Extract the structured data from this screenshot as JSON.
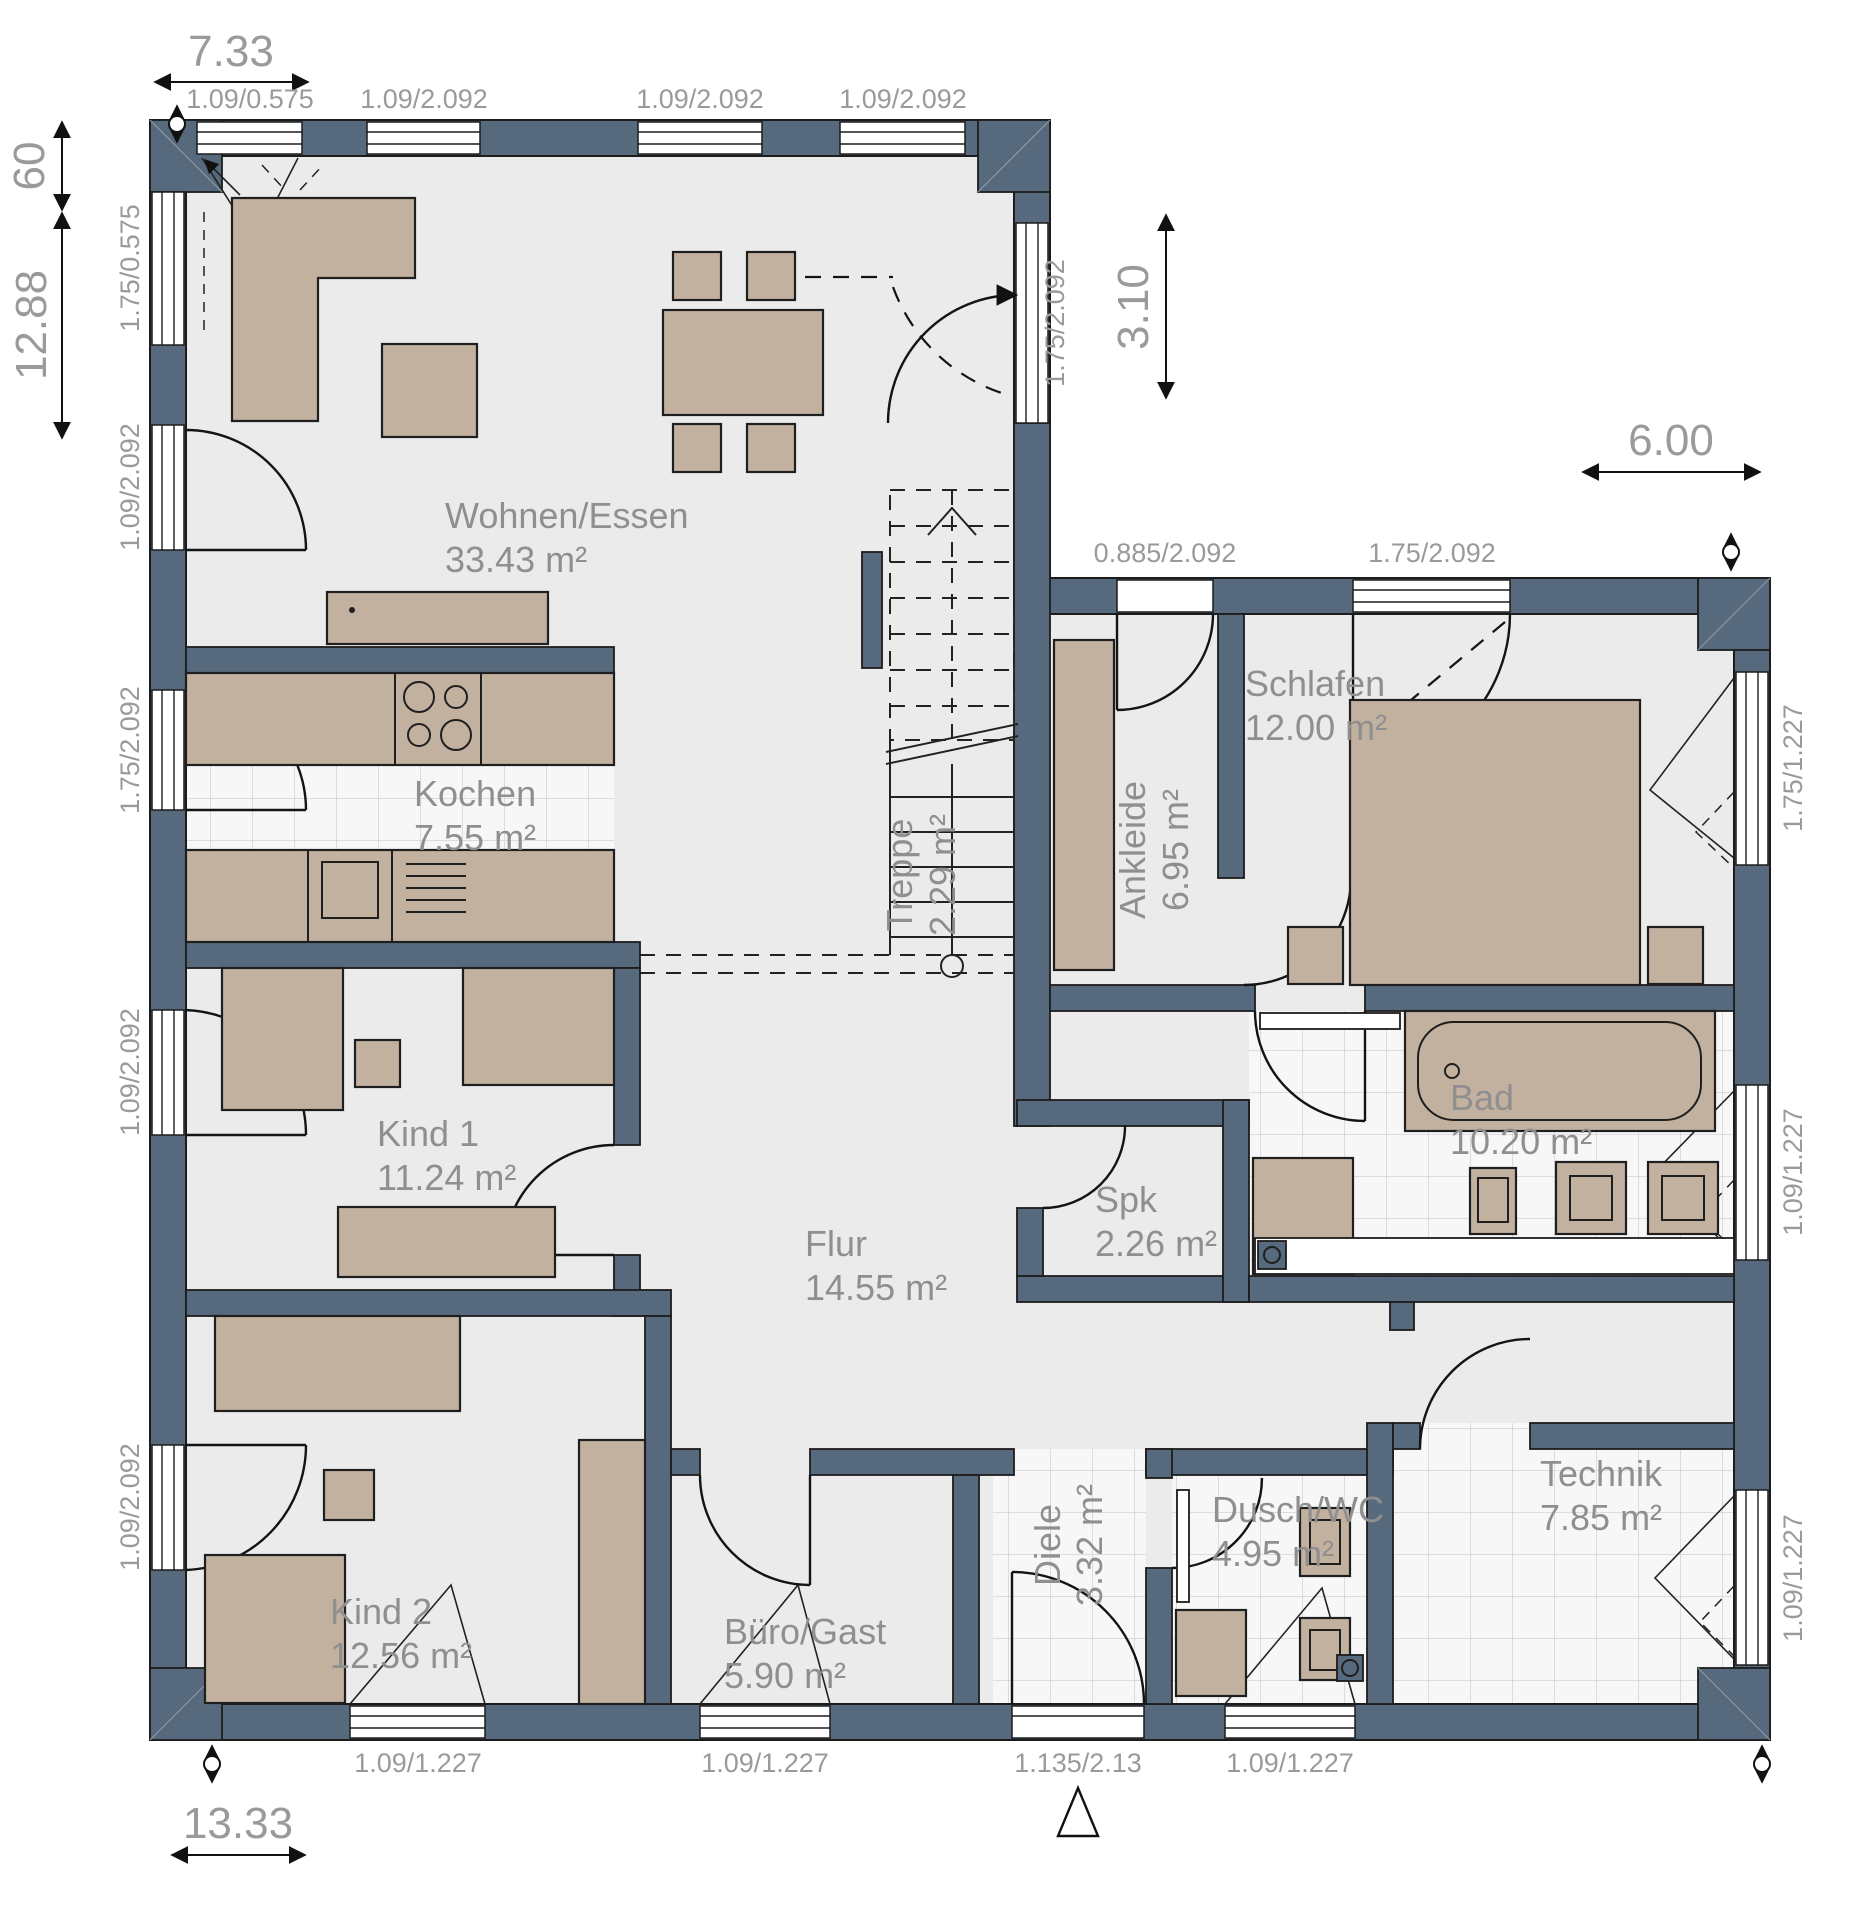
{
  "plan_title": "Erdgeschoss Grundriss (Bungalow)",
  "colors": {
    "wall": "#57697d",
    "furniture": "#c3b1a0",
    "floor": "#ebebeb",
    "label_gray": "#9a9a9a"
  },
  "rooms": [
    {
      "name": "Wohnen/Essen",
      "area": "33.43 m²",
      "nx": 445,
      "ny": 528,
      "ax": 445,
      "ay": 572,
      "rot": false
    },
    {
      "name": "Kochen",
      "area": "7.55 m²",
      "nx": 414,
      "ny": 806,
      "ax": 414,
      "ay": 850,
      "rot": false
    },
    {
      "name": "Kind 1",
      "area": "11.24 m²",
      "nx": 377,
      "ny": 1146,
      "ax": 377,
      "ay": 1190,
      "rot": false
    },
    {
      "name": "Kind 2",
      "area": "12.56 m²",
      "nx": 330,
      "ny": 1624,
      "ax": 330,
      "ay": 1668,
      "rot": false
    },
    {
      "name": "Büro/Gast",
      "area": "5.90 m²",
      "nx": 724,
      "ny": 1644,
      "ax": 724,
      "ay": 1688,
      "rot": false
    },
    {
      "name": "Flur",
      "area": "14.55 m²",
      "nx": 805,
      "ny": 1256,
      "ax": 805,
      "ay": 1300,
      "rot": false
    },
    {
      "name": "Spk",
      "area": "2.26 m²",
      "nx": 1095,
      "ny": 1212,
      "ax": 1095,
      "ay": 1256,
      "rot": false
    },
    {
      "name": "Schlafen",
      "area": "12.00 m²",
      "nx": 1245,
      "ny": 696,
      "ax": 1245,
      "ay": 740,
      "rot": false
    },
    {
      "name": "Bad",
      "area": "10.20 m²",
      "nx": 1450,
      "ny": 1110,
      "ax": 1450,
      "ay": 1154,
      "rot": false
    },
    {
      "name": "Dusch/WC",
      "area": "4.95 m²",
      "nx": 1212,
      "ny": 1522,
      "ax": 1212,
      "ay": 1566,
      "rot": false
    },
    {
      "name": "Technik",
      "area": "7.85 m²",
      "nx": 1540,
      "ny": 1486,
      "ax": 1540,
      "ay": 1530,
      "rot": false
    },
    {
      "name": "Treppe",
      "area": "2.29 m²",
      "nx": 912,
      "ny": 875,
      "ax": 955,
      "ay": 875,
      "rot": true
    },
    {
      "name": "Ankleide",
      "area": "6.95 m²",
      "nx": 1145,
      "ny": 850,
      "ax": 1188,
      "ay": 850,
      "rot": true
    },
    {
      "name": "Diele",
      "area": "3.32 m²",
      "nx": 1060,
      "ny": 1545,
      "ax": 1102,
      "ay": 1545,
      "rot": true
    }
  ],
  "opening_labels": [
    {
      "t": "1.09/0.575",
      "x": 250,
      "y": 108,
      "rot": false
    },
    {
      "t": "1.09/2.092",
      "x": 424,
      "y": 108,
      "rot": false
    },
    {
      "t": "1.09/2.092",
      "x": 700,
      "y": 108,
      "rot": false
    },
    {
      "t": "1.09/2.092",
      "x": 903,
      "y": 108,
      "rot": false
    },
    {
      "t": "0.885/2.092",
      "x": 1165,
      "y": 562,
      "rot": false
    },
    {
      "t": "1.75/2.092",
      "x": 1432,
      "y": 562,
      "rot": false
    },
    {
      "t": "1.75/0.575",
      "x": 139,
      "y": 268,
      "rot": true
    },
    {
      "t": "1.09/2.092",
      "x": 139,
      "y": 487,
      "rot": true
    },
    {
      "t": "1.75/2.092",
      "x": 139,
      "y": 750,
      "rot": true
    },
    {
      "t": "1.09/2.092",
      "x": 139,
      "y": 1072,
      "rot": true
    },
    {
      "t": "1.09/2.092",
      "x": 139,
      "y": 1507,
      "rot": true
    },
    {
      "t": "1.75/2.092",
      "x": 1064,
      "y": 323,
      "rot": true
    },
    {
      "t": "1.75/1.227",
      "x": 1802,
      "y": 768,
      "rot": true
    },
    {
      "t": "1.09/1.227",
      "x": 1802,
      "y": 1172,
      "rot": true
    },
    {
      "t": "1.09/1.227",
      "x": 1802,
      "y": 1578,
      "rot": true
    },
    {
      "t": "1.09/1.227",
      "x": 418,
      "y": 1772,
      "rot": false
    },
    {
      "t": "1.09/1.227",
      "x": 765,
      "y": 1772,
      "rot": false
    },
    {
      "t": "1.135/2.13",
      "x": 1078,
      "y": 1772,
      "rot": false
    },
    {
      "t": "1.09/1.227",
      "x": 1290,
      "y": 1772,
      "rot": false
    }
  ],
  "dimensions": [
    {
      "t": "7.33",
      "x": 231,
      "y": 66,
      "rot": false
    },
    {
      "t": "60",
      "x": 44,
      "y": 166,
      "rot": true
    },
    {
      "t": "12.88",
      "x": 46,
      "y": 325,
      "rot": true
    },
    {
      "t": "3.10",
      "x": 1148,
      "y": 307,
      "rot": true
    },
    {
      "t": "6.00",
      "x": 1671,
      "y": 455,
      "rot": false
    },
    {
      "t": "13.33",
      "x": 238,
      "y": 1838,
      "rot": false
    }
  ]
}
